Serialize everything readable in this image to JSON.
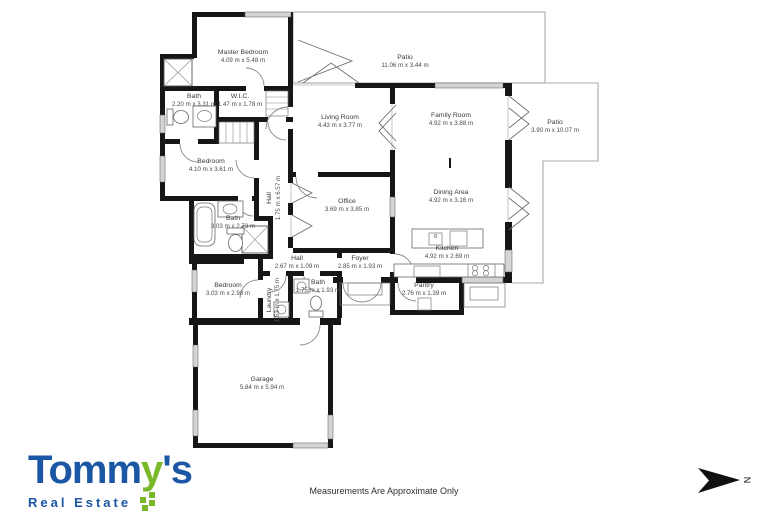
{
  "plan": {
    "rooms": [
      {
        "name": "Master Bedroom",
        "dims": "4.09 m x 5.48 m"
      },
      {
        "name": "Bath",
        "dims": "2.20 m x 3.31 m"
      },
      {
        "name": "W.I.C.",
        "dims": "1.47 m x 1.78 m"
      },
      {
        "name": "Patio",
        "dims": "11.06 m x 3.44 m"
      },
      {
        "name": "Living Room",
        "dims": "4.43 m x 3.77 m"
      },
      {
        "name": "Family Room",
        "dims": "4.92 m x 3.88 m"
      },
      {
        "name": "Patio",
        "dims": "3.90 m x 10.07 m"
      },
      {
        "name": "Bedroom",
        "dims": "4.10 m x 3.61 m"
      },
      {
        "name": "Hall",
        "dims": "1.75 m x 6.57 m"
      },
      {
        "name": "Office",
        "dims": "3.69 m x 3.85 m"
      },
      {
        "name": "Bath",
        "dims": "3.03 m x 2.73 m"
      },
      {
        "name": "Dining Area",
        "dims": "4.92 m x 3.16 m"
      },
      {
        "name": "Kitchen",
        "dims": "4.92 m x 2.69 m"
      },
      {
        "name": "Hall",
        "dims": "2.67 m x 1.09 m"
      },
      {
        "name": "Foyer",
        "dims": "2.85 m x 1.93 m"
      },
      {
        "name": "Bedroom",
        "dims": "3.03 m x 2.98 m"
      },
      {
        "name": "Laundry",
        "dims": "1.53 m x 1.75 m"
      },
      {
        "name": "Bath",
        "dims": "1.75 m x 1.93 m"
      },
      {
        "name": "Garage",
        "dims": "5.84 m x 5.94 m"
      },
      {
        "name": "Pantry",
        "dims": "2.76 m x 1.39 m"
      }
    ]
  },
  "footer": {
    "disclaimer": "Measurements Are Approximate Only",
    "north_label": "N"
  },
  "logo": {
    "part1": "Tomm",
    "part2": "y",
    "part3": "'s",
    "subtitle": "Real Estate",
    "blue": "#1c57a5",
    "green": "#7ab829"
  }
}
